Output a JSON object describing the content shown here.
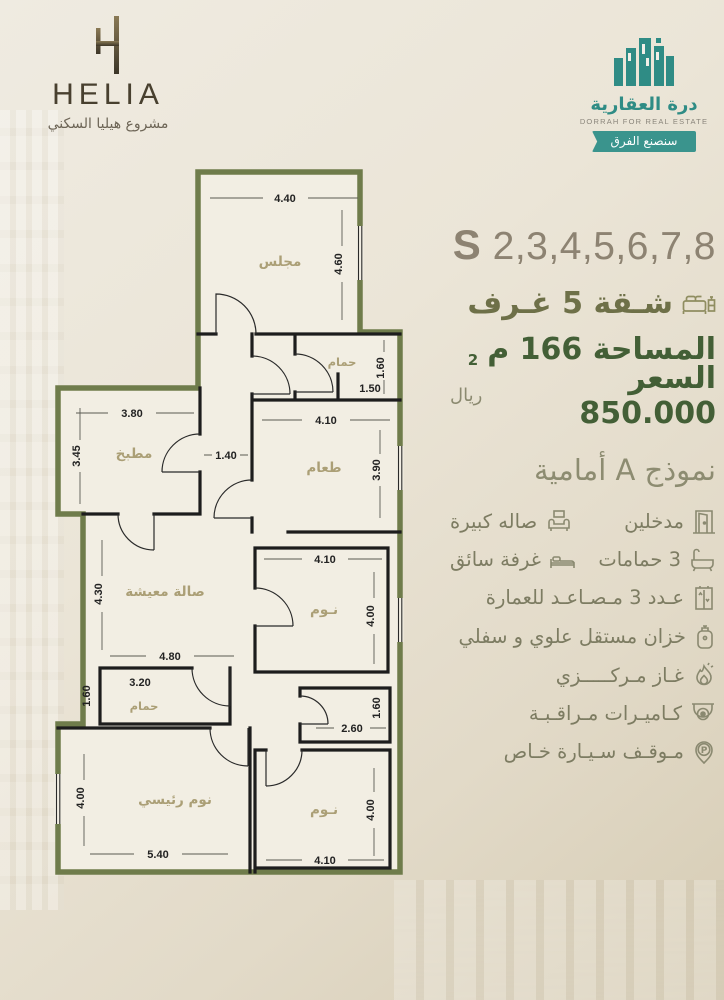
{
  "header": {
    "helia": {
      "name": "HELIA",
      "tagline": "مشروع هيليا السكني"
    },
    "dorrah": {
      "name_ar": "درة العقارية",
      "name_en": "DORRAH FOR REAL ESTATE",
      "tagline": "سنصنع الفرق"
    }
  },
  "offer": {
    "series_letter": "S",
    "series_numbers": "2,3,4,5,6,7,8",
    "apartment_line": "شـقة 5 غـرف",
    "area_line": "المساحة 166 م",
    "area_superscript": "2",
    "price_line": "السعر 850.000",
    "currency": "ريال",
    "model_line": "نموذج A أمامية"
  },
  "features": {
    "parking_letter": "P",
    "items": [
      {
        "icon": "door-icon",
        "text": "مدخلين"
      },
      {
        "icon": "sofa-icon",
        "text": "صاله كبيرة"
      },
      {
        "icon": "bathtub-icon",
        "text": "3 حمامات"
      },
      {
        "icon": "bed-icon",
        "text": "غرفة سائق"
      },
      {
        "icon": "elevator-icon",
        "text": "عـدد 3 مـصـاعـد للعمارة"
      },
      {
        "icon": "tank-icon",
        "text": "خزان مستقل علوي و سفلي"
      },
      {
        "icon": "flame-icon",
        "text": "غـاز مـركـــــزي"
      },
      {
        "icon": "camera-icon",
        "text": "كـاميـرات مـراقـبـة"
      },
      {
        "icon": "parking-icon",
        "text": "مـوقـف سـيـارة خـاص"
      }
    ]
  },
  "plan": {
    "rooms": [
      {
        "label": "مجلس"
      },
      {
        "label": "حمام"
      },
      {
        "label": "طعام"
      },
      {
        "label": "مطبخ"
      },
      {
        "label": "صالة معيشة"
      },
      {
        "label": "حمام"
      },
      {
        "label": "نوم رئيسي"
      },
      {
        "label": "نـوم"
      },
      {
        "label": "نـوم"
      }
    ],
    "dims": [
      "4.40",
      "4.60",
      "1.60",
      "1.50",
      "4.10",
      "3.90",
      "3.80",
      "3.45",
      "1.40",
      "4.30",
      "4.80",
      "3.20",
      "1.60",
      "4.00",
      "5.40",
      "4.10",
      "4.00",
      "2.60",
      "1.60",
      "4.00",
      "4.10"
    ]
  },
  "colors": {
    "dark_green": "#435f36",
    "olive": "#6e7048",
    "taupe": "#8d8372",
    "teal": "#2f8c85",
    "plan_outline": "#6f7c4b"
  }
}
